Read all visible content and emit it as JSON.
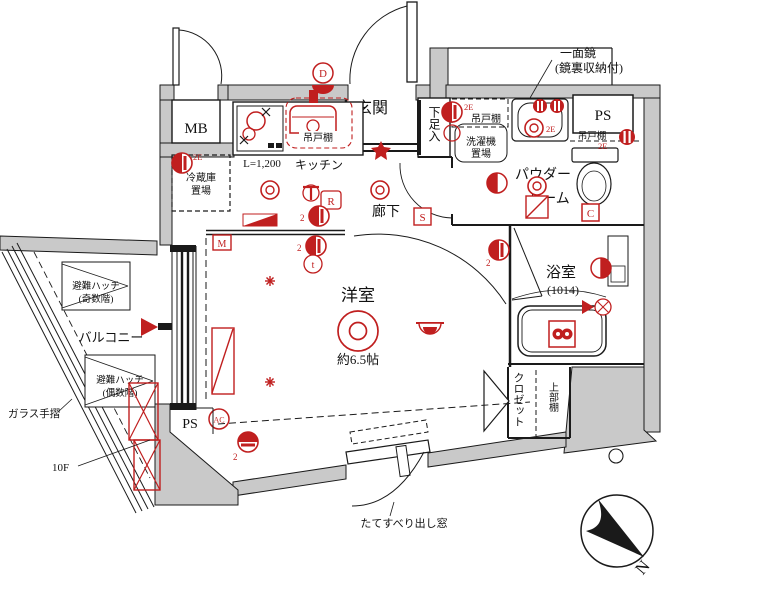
{
  "title": "apartment-floor-plan",
  "colors": {
    "accent_red": "#c01f1f",
    "wall_gray": "#c9c9c9",
    "line_black": "#1a1a1a"
  },
  "labels": {
    "mb": "MB",
    "genkan": "玄関",
    "shoe": "下足入",
    "ps_top": "PS",
    "ps_bottom": "PS",
    "hood": "吊戸棚",
    "counter_len": "L=1,200",
    "kitchen": "キッチン",
    "fridge1": "冷蔵庫",
    "fridge2": "置場",
    "corridor": "廊下",
    "shelf_laundry": "吊戸棚",
    "laundry1": "洗濯機",
    "laundry2": "置場",
    "mirror1": "一面鏡",
    "mirror2": "(鏡裏収納付)",
    "powder1": "パウダー",
    "powder2": "ルーム",
    "shelf_toilet": "吊戸棚",
    "bath": "浴室",
    "bath_size": "(1014)",
    "closet": "クロゼット",
    "upper_shelf": "上部棚",
    "room": "洋室",
    "room_size": "約6.5帖",
    "balcony": "バルコニー",
    "hatch_a1": "避難ハッチ",
    "hatch_a2": "(奇数階)",
    "hatch_b1": "避難ハッチ",
    "hatch_b2": "(偶数階)",
    "glass_rail": "ガラス手摺",
    "floor": "10F",
    "window": "たてすべり出し窓",
    "north": "N"
  },
  "marks": {
    "d": "D",
    "s": "S",
    "m": "M",
    "c": "C",
    "r": "R",
    "t": "t",
    "ac": "AC",
    "two": "2",
    "two_e": "2E"
  }
}
